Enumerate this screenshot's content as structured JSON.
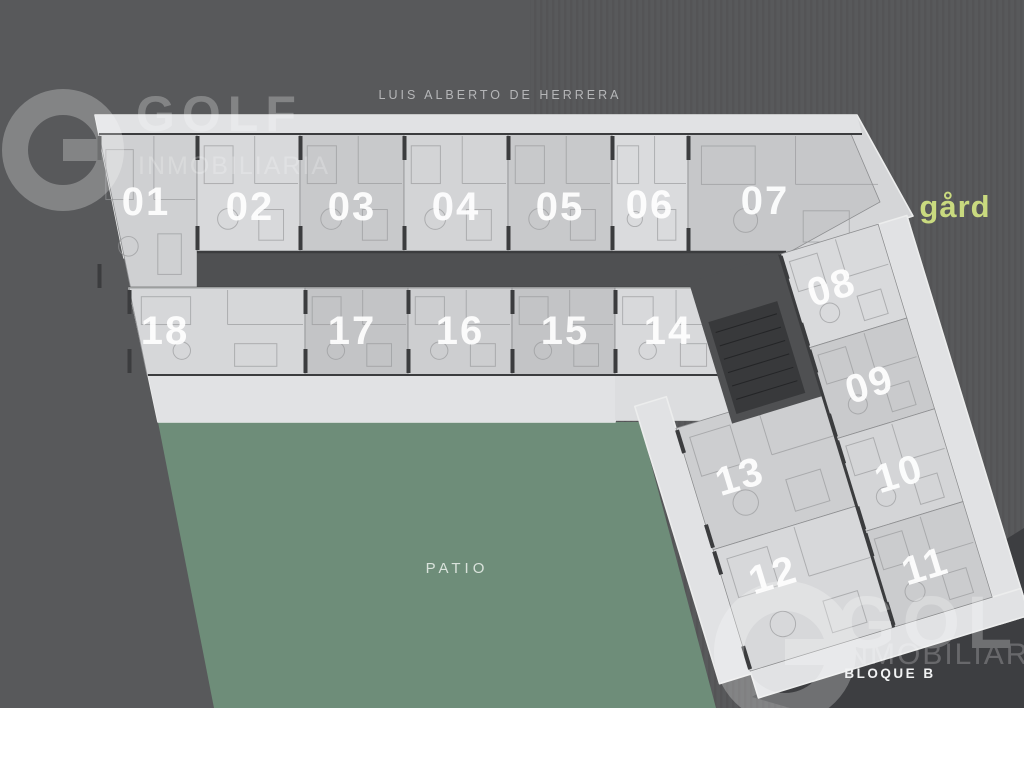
{
  "street_label": "LUIS ALBERTO DE HERRERA",
  "patio_label": "PATIO",
  "block_label": "BLOQUE B",
  "brand": {
    "name": "gård",
    "color": "#c9da7f"
  },
  "watermark": {
    "word": "GOLF",
    "sub": "INMOBILIARIA"
  },
  "units": [
    {
      "number": "01"
    },
    {
      "number": "02"
    },
    {
      "number": "03"
    },
    {
      "number": "04"
    },
    {
      "number": "05"
    },
    {
      "number": "06"
    },
    {
      "number": "07"
    },
    {
      "number": "18"
    },
    {
      "number": "17"
    },
    {
      "number": "16"
    },
    {
      "number": "15"
    },
    {
      "number": "14"
    },
    {
      "number": "08"
    },
    {
      "number": "09"
    },
    {
      "number": "10"
    },
    {
      "number": "11"
    },
    {
      "number": "13"
    },
    {
      "number": "12"
    }
  ],
  "colors": {
    "background": "#58595b",
    "patio_green": "#6e8d79",
    "plan_light": "#d5d6d8",
    "balcony_light": "#e1e2e4",
    "corridor_dark": "#4f5052",
    "shaft_dark": "#38393b",
    "shadow": "#3d3e41",
    "white_band": "#ffffff",
    "street_text": "#b5b6b8"
  }
}
